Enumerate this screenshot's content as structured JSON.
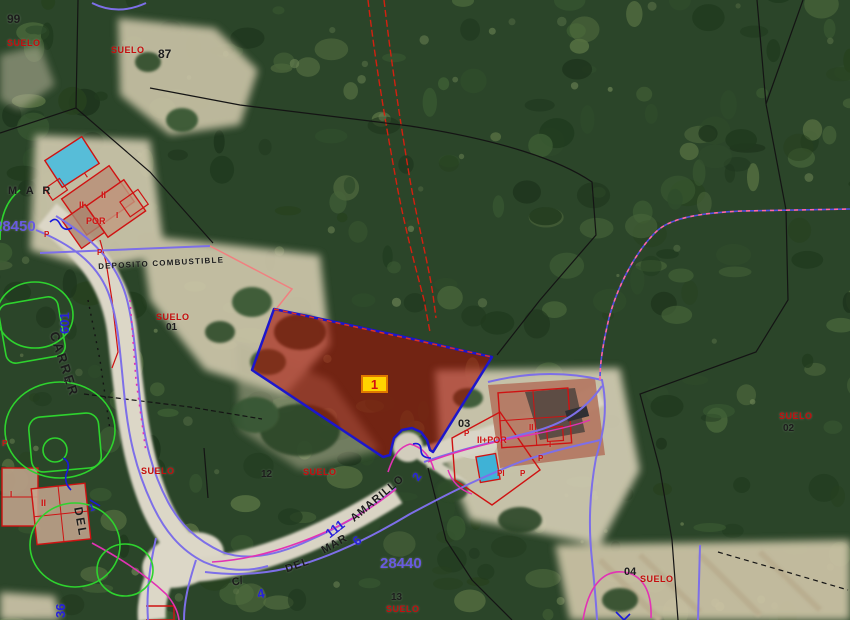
{
  "map": {
    "badge": {
      "text": "1"
    },
    "colors": {
      "black": "#1c1c1c",
      "red": "#cf1212",
      "suelo": "#c40d0d",
      "blue": "#2620dc",
      "violet": "#685ae0"
    },
    "labels": [
      {
        "t": "99",
        "x": 7,
        "y": 13,
        "r": 0,
        "s": 12,
        "c": "black",
        "w": 700
      },
      {
        "t": "SUELO",
        "x": 7,
        "y": 39,
        "r": 0,
        "s": 9,
        "c": "suelo",
        "w": 700,
        "ls": 0.5
      },
      {
        "t": "SUELO",
        "x": 111,
        "y": 46,
        "r": 0,
        "s": 9,
        "c": "suelo",
        "w": 700,
        "ls": 0.5
      },
      {
        "t": "87",
        "x": 158,
        "y": 48,
        "r": 0,
        "s": 12,
        "c": "black",
        "w": 700
      },
      {
        "t": "28450",
        "x": -6,
        "y": 219,
        "r": 0,
        "s": 15,
        "c": "violet",
        "w": 700
      },
      {
        "t": "M A R",
        "x": 8,
        "y": 186,
        "r": 0,
        "s": 11,
        "c": "black",
        "w": 700,
        "ls": 3
      },
      {
        "t": "601",
        "x": 58,
        "y": 334,
        "r": -90,
        "s": 13,
        "c": "blue",
        "w": 700
      },
      {
        "t": "CARRER",
        "x": 60,
        "y": 330,
        "r": 72,
        "s": 13,
        "c": "black",
        "w": 700,
        "ls": 2
      },
      {
        "t": "DEL",
        "x": 84,
        "y": 506,
        "r": 80,
        "s": 12,
        "c": "black",
        "w": 700,
        "ls": 2
      },
      {
        "t": "36",
        "x": 54,
        "y": 618,
        "r": -90,
        "s": 13,
        "c": "blue",
        "w": 700
      },
      {
        "t": "DEPOSITO COMBUSTIBLE",
        "x": 98,
        "y": 263,
        "r": -3,
        "s": 8,
        "c": "black",
        "w": 700,
        "ls": 1.2
      },
      {
        "t": "SUELO",
        "x": 156,
        "y": 313,
        "r": 0,
        "s": 9,
        "c": "suelo",
        "w": 700,
        "ls": 0.5
      },
      {
        "t": "01",
        "x": 166,
        "y": 323,
        "r": 0,
        "s": 10,
        "c": "black",
        "w": 700
      },
      {
        "t": "A.",
        "x": 64,
        "y": 377,
        "r": 0,
        "s": 7,
        "c": "black",
        "w": 400
      },
      {
        "t": "SUELO",
        "x": 141,
        "y": 467,
        "r": 0,
        "s": 9,
        "c": "suelo",
        "w": 700,
        "ls": 0.5
      },
      {
        "t": "12",
        "x": 261,
        "y": 470,
        "r": 0,
        "s": 10,
        "c": "black",
        "w": 700
      },
      {
        "t": "SUELO",
        "x": 303,
        "y": 468,
        "r": 0,
        "s": 9,
        "c": "suelo",
        "w": 700,
        "ls": 0.5
      },
      {
        "t": "C/",
        "x": 231,
        "y": 578,
        "r": -12,
        "s": 11,
        "c": "black",
        "w": 700
      },
      {
        "t": "4",
        "x": 256,
        "y": 588,
        "r": -12,
        "s": 13,
        "c": "blue",
        "w": 700
      },
      {
        "t": "DEL",
        "x": 284,
        "y": 565,
        "r": -20,
        "s": 11,
        "c": "black",
        "w": 700,
        "ls": 1
      },
      {
        "t": "MAR",
        "x": 320,
        "y": 547,
        "r": -30,
        "s": 11,
        "c": "black",
        "w": 700,
        "ls": 1
      },
      {
        "t": "111",
        "x": 323,
        "y": 530,
        "r": -38,
        "s": 13,
        "c": "blue",
        "w": 700
      },
      {
        "t": "6",
        "x": 350,
        "y": 538,
        "r": -40,
        "s": 13,
        "c": "blue",
        "w": 700
      },
      {
        "t": "AMARILLO",
        "x": 349,
        "y": 516,
        "r": -40,
        "s": 11,
        "c": "black",
        "w": 700,
        "ls": 1
      },
      {
        "t": "2",
        "x": 410,
        "y": 476,
        "r": -55,
        "s": 12,
        "c": "blue",
        "w": 700
      },
      {
        "t": "28440",
        "x": 380,
        "y": 556,
        "r": 0,
        "s": 15,
        "c": "violet",
        "w": 700
      },
      {
        "t": "13",
        "x": 391,
        "y": 593,
        "r": 0,
        "s": 10,
        "c": "black",
        "w": 700
      },
      {
        "t": "SUELO",
        "x": 386,
        "y": 605,
        "r": 0,
        "s": 9,
        "c": "suelo",
        "w": 700,
        "ls": 0.5
      },
      {
        "t": "03",
        "x": 458,
        "y": 419,
        "r": 0,
        "s": 11,
        "c": "black",
        "w": 700
      },
      {
        "t": "P",
        "x": 464,
        "y": 430,
        "r": 0,
        "s": 8,
        "c": "red",
        "w": 700
      },
      {
        "t": "II+POR",
        "x": 477,
        "y": 436,
        "r": 0,
        "s": 9,
        "c": "red",
        "w": 700
      },
      {
        "t": "II",
        "x": 529,
        "y": 424,
        "r": 0,
        "s": 8,
        "c": "red",
        "w": 700
      },
      {
        "t": "I",
        "x": 549,
        "y": 441,
        "r": 0,
        "s": 8,
        "c": "red",
        "w": 700
      },
      {
        "t": "P",
        "x": 538,
        "y": 455,
        "r": 0,
        "s": 8,
        "c": "red",
        "w": 700
      },
      {
        "t": "PI",
        "x": 497,
        "y": 470,
        "r": 0,
        "s": 8,
        "c": "red",
        "w": 700
      },
      {
        "t": "P",
        "x": 520,
        "y": 470,
        "r": 0,
        "s": 8,
        "c": "red",
        "w": 700
      },
      {
        "t": "SUELO",
        "x": 779,
        "y": 412,
        "r": 0,
        "s": 9,
        "c": "suelo",
        "w": 700,
        "ls": 0.5
      },
      {
        "t": "02",
        "x": 783,
        "y": 424,
        "r": 0,
        "s": 10,
        "c": "black",
        "w": 600
      },
      {
        "t": "04",
        "x": 624,
        "y": 567,
        "r": 0,
        "s": 11,
        "c": "black",
        "w": 700
      },
      {
        "t": "SUELO",
        "x": 640,
        "y": 575,
        "r": 0,
        "s": 9,
        "c": "suelo",
        "w": 700,
        "ls": 0.5
      },
      {
        "t": "I",
        "x": 83,
        "y": 173,
        "r": -35,
        "s": 8,
        "c": "red",
        "w": 700
      },
      {
        "t": "II",
        "x": 101,
        "y": 191,
        "r": 0,
        "s": 9,
        "c": "red",
        "w": 700
      },
      {
        "t": "II",
        "x": 79,
        "y": 201,
        "r": 0,
        "s": 9,
        "c": "red",
        "w": 700
      },
      {
        "t": "POR",
        "x": 86,
        "y": 217,
        "r": 0,
        "s": 9,
        "c": "red",
        "w": 700
      },
      {
        "t": "I",
        "x": 116,
        "y": 212,
        "r": 0,
        "s": 8,
        "c": "red",
        "w": 700
      },
      {
        "t": "P",
        "x": 44,
        "y": 231,
        "r": 0,
        "s": 8,
        "c": "red",
        "w": 700
      },
      {
        "t": "P",
        "x": 97,
        "y": 249,
        "r": 0,
        "s": 8,
        "c": "red",
        "w": 700
      },
      {
        "t": "P",
        "x": 2,
        "y": 440,
        "r": 0,
        "s": 8,
        "c": "red",
        "w": 700
      },
      {
        "t": "I",
        "x": 10,
        "y": 491,
        "r": 0,
        "s": 8,
        "c": "red",
        "w": 700
      },
      {
        "t": "II",
        "x": 41,
        "y": 499,
        "r": 0,
        "s": 9,
        "c": "red",
        "w": 700
      },
      {
        "t": "1",
        "x": 88,
        "y": 505,
        "r": -20,
        "s": 10,
        "c": "blue",
        "w": 700
      }
    ]
  }
}
